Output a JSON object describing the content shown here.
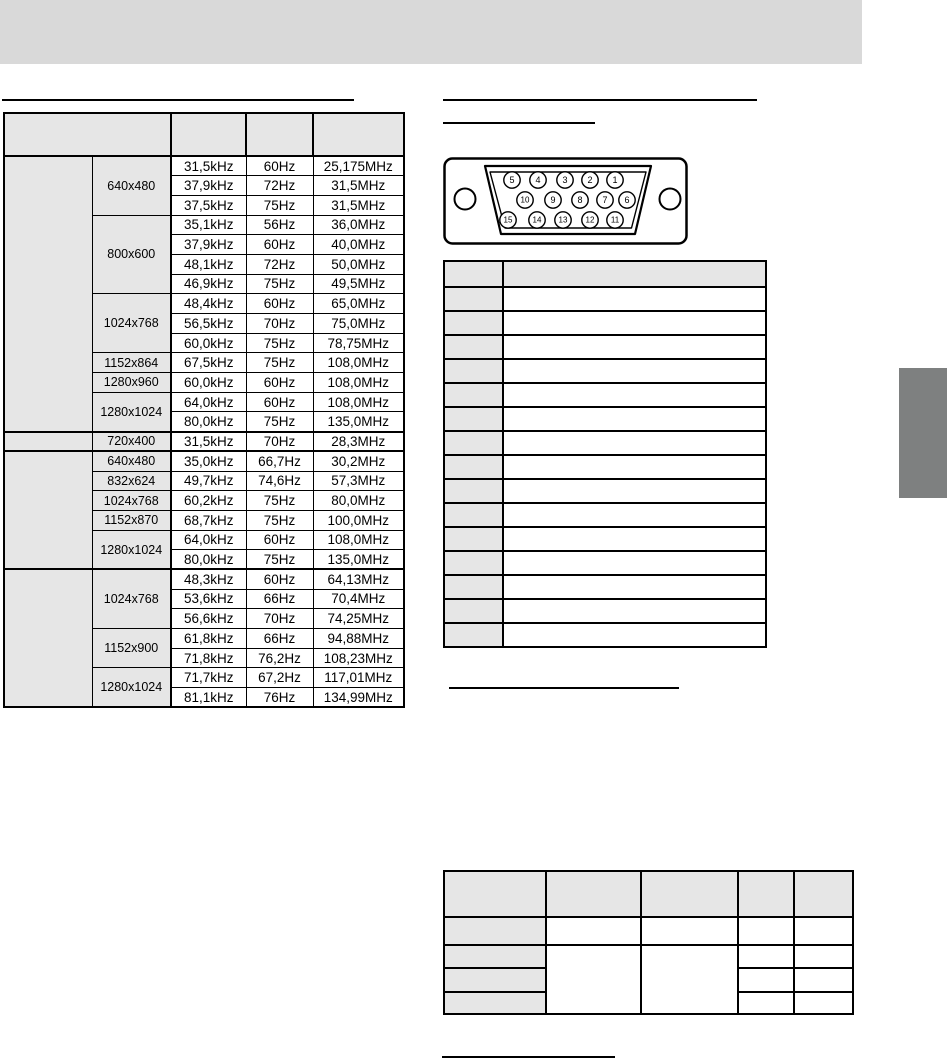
{
  "colors": {
    "banner": "#d9d9d9",
    "cell_shade": "#e6e6e6",
    "side_tab": "#7e8080",
    "line": "#000000"
  },
  "timing_table": {
    "header": [
      "",
      "",
      "",
      ""
    ],
    "groups": [
      {
        "label": "",
        "modes": [
          {
            "res": "640x480",
            "rows": [
              [
                "31,5kHz",
                "60Hz",
                "25,175MHz"
              ],
              [
                "37,9kHz",
                "72Hz",
                "31,5MHz"
              ],
              [
                "37,5kHz",
                "75Hz",
                "31,5MHz"
              ]
            ]
          },
          {
            "res": "800x600",
            "rows": [
              [
                "35,1kHz",
                "56Hz",
                "36,0MHz"
              ],
              [
                "37,9kHz",
                "60Hz",
                "40,0MHz"
              ],
              [
                "48,1kHz",
                "72Hz",
                "50,0MHz"
              ],
              [
                "46,9kHz",
                "75Hz",
                "49,5MHz"
              ]
            ]
          },
          {
            "res": "1024x768",
            "rows": [
              [
                "48,4kHz",
                "60Hz",
                "65,0MHz"
              ],
              [
                "56,5kHz",
                "70Hz",
                "75,0MHz"
              ],
              [
                "60,0kHz",
                "75Hz",
                "78,75MHz"
              ]
            ]
          },
          {
            "res": "1152x864",
            "rows": [
              [
                "67,5kHz",
                "75Hz",
                "108,0MHz"
              ]
            ]
          },
          {
            "res": "1280x960",
            "rows": [
              [
                "60,0kHz",
                "60Hz",
                "108,0MHz"
              ]
            ]
          },
          {
            "res": "1280x1024",
            "rows": [
              [
                "64,0kHz",
                "60Hz",
                "108,0MHz"
              ],
              [
                "80,0kHz",
                "75Hz",
                "135,0MHz"
              ]
            ]
          }
        ]
      },
      {
        "label": "",
        "modes": [
          {
            "res": "720x400",
            "rows": [
              [
                "31,5kHz",
                "70Hz",
                "28,3MHz"
              ]
            ]
          }
        ]
      },
      {
        "label": "",
        "modes": [
          {
            "res": "640x480",
            "rows": [
              [
                "35,0kHz",
                "66,7Hz",
                "30,2MHz"
              ]
            ]
          },
          {
            "res": "832x624",
            "rows": [
              [
                "49,7kHz",
                "74,6Hz",
                "57,3MHz"
              ]
            ]
          },
          {
            "res": "1024x768",
            "rows": [
              [
                "60,2kHz",
                "75Hz",
                "80,0MHz"
              ]
            ]
          },
          {
            "res": "1152x870",
            "rows": [
              [
                "68,7kHz",
                "75Hz",
                "100,0MHz"
              ]
            ]
          },
          {
            "res": "1280x1024",
            "rows": [
              [
                "64,0kHz",
                "60Hz",
                "108,0MHz"
              ],
              [
                "80,0kHz",
                "75Hz",
                "135,0MHz"
              ]
            ]
          }
        ]
      },
      {
        "label": "",
        "modes": [
          {
            "res": "1024x768",
            "rows": [
              [
                "48,3kHz",
                "60Hz",
                "64,13MHz"
              ],
              [
                "53,6kHz",
                "66Hz",
                "70,4MHz"
              ],
              [
                "56,6kHz",
                "70Hz",
                "74,25MHz"
              ]
            ]
          },
          {
            "res": "1152x900",
            "rows": [
              [
                "61,8kHz",
                "66Hz",
                "94,88MHz"
              ],
              [
                "71,8kHz",
                "76,2Hz",
                "108,23MHz"
              ]
            ]
          },
          {
            "res": "1280x1024",
            "rows": [
              [
                "71,7kHz",
                "67,2Hz",
                "117,01MHz"
              ],
              [
                "81,1kHz",
                "76Hz",
                "134,99MHz"
              ]
            ]
          }
        ]
      }
    ]
  },
  "connector_diagram": {
    "pin_rows": [
      [
        "5",
        "4",
        "3",
        "2",
        "1"
      ],
      [
        "10",
        "9",
        "8",
        "7",
        "6"
      ],
      [
        "15",
        "14",
        "13",
        "12",
        "11"
      ]
    ]
  },
  "pin_table": {
    "header": [
      "",
      ""
    ],
    "row_count": 15
  },
  "signal_table": {
    "header": [
      "",
      "",
      "",
      "",
      ""
    ],
    "row_count": 4
  }
}
